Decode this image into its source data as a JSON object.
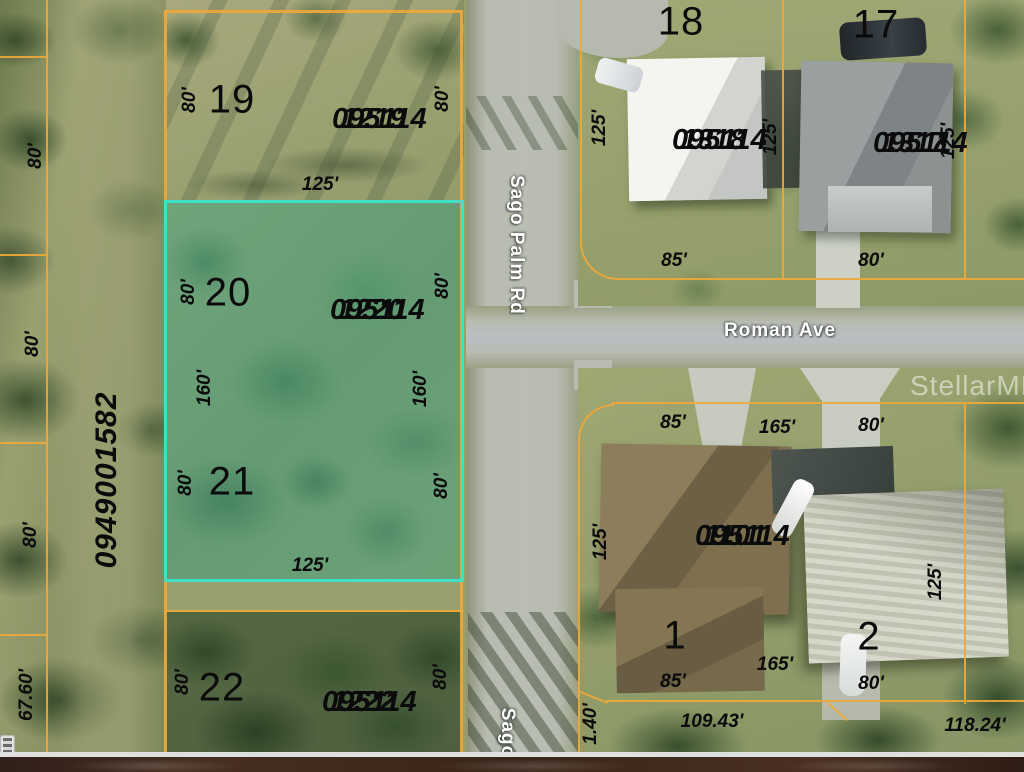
{
  "watermark": "StellarMLS",
  "streets": {
    "sago_palm_rd": "Sago Palm Rd",
    "sago_partial": "Sago",
    "roman_ave": "Roman Ave"
  },
  "lots": {
    "n19": "19",
    "n18": "18",
    "n17": "17",
    "n20": "20",
    "n21": "21",
    "n22": "22",
    "n1": "1",
    "n2": "2"
  },
  "parcels": {
    "p1219": {
      "l1": "095114",
      "l2": "1219"
    },
    "p1318": {
      "l1": "095114",
      "l2": "1318"
    },
    "p1317": {
      "l1": "095114",
      "l2": "1317"
    },
    "p1220": {
      "l1": "095114",
      "l2": "1220"
    },
    "p1222": {
      "l1": "095114",
      "l2": "1222"
    },
    "p1101": {
      "l1": "095114",
      "l2": "1101"
    }
  },
  "strip_parcel": "0949001582",
  "dims": {
    "lot19_w": "80'",
    "lot19_e": "80'",
    "lot19_s": "125'",
    "lot18_w": "125'",
    "lot18_e": "125'",
    "lot18_s": "85'",
    "lot17_e": "125'",
    "lot17_s": "80'",
    "lot20_w": "80'",
    "lot20_e": "80'",
    "mid_w": "160'",
    "mid_e": "160'",
    "lot21_w": "80'",
    "lot21_e": "80'",
    "lot21_s": "125'",
    "strip1": "80'",
    "strip2": "80'",
    "strip3": "80'",
    "strip4": "67.60'",
    "lot22_w": "80'",
    "lot22_e": "80'",
    "lot1101_n": "85'",
    "mid_n": "165'",
    "lot2_n": "80'",
    "lot1101_w": "125'",
    "lot2_e": "125'",
    "lot1_s": "85'",
    "mid_s": "165'",
    "lot2_s": "80'",
    "lot1_arc": "109.43'",
    "lot2_arc": "118.24'",
    "sliver": "1.40'",
    "edge_right_top": "0",
    "edge_right_mid": "0"
  },
  "colors": {
    "parcel_line": "#efa83a",
    "highlight": "#3fe0c5"
  }
}
